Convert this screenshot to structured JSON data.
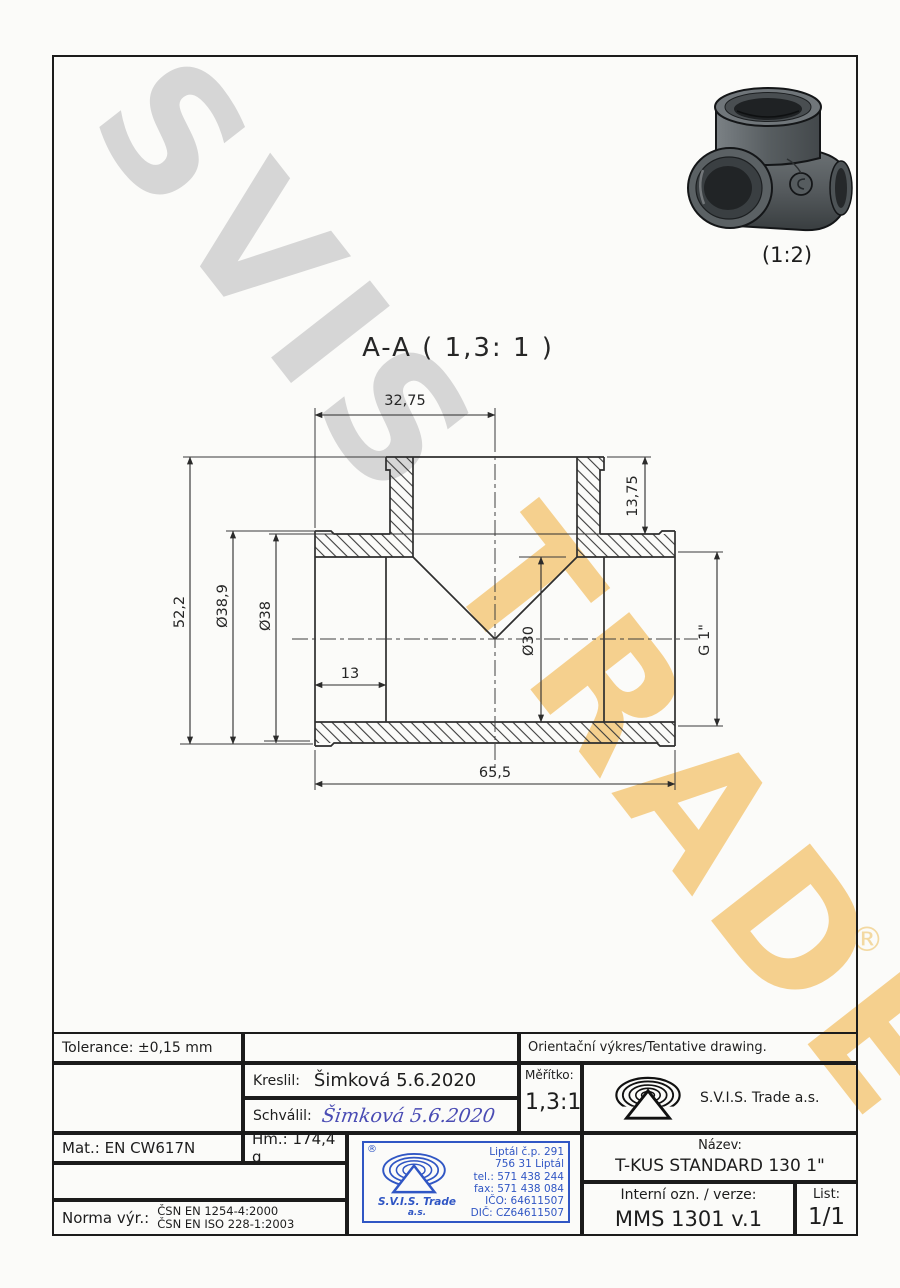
{
  "watermark": {
    "part1": "SVIS",
    "part2": "TRADE",
    "registered": "®",
    "color_gray": "#d6d6d6",
    "color_yellow": "#f5c97c"
  },
  "pictorial": {
    "scale_label": "(1:2)"
  },
  "section": {
    "title": "A-A ( 1,3: 1 )",
    "dims": {
      "top_width": "32,75",
      "height": "52,2",
      "od_bead": "Ø38,9",
      "od_body": "Ø38",
      "port_depth": "13",
      "branch_depth": "13,75",
      "bore": "Ø30",
      "thread": "G 1\"",
      "total_length": "65,5"
    }
  },
  "title_block": {
    "tolerance": "Tolerance: ±0,15 mm",
    "orientation_note": "Orientační výkres/Tentative drawing.",
    "kreslil_label": "Kreslil:",
    "kreslil_value": "Šimková 5.6.2020",
    "schvalil_label": "Schválil:",
    "schvalil_signature": "Šimková 5.6.2020",
    "meritko_label": "Měřítko:",
    "meritko_value": "1,3:1",
    "company": "S.V.I.S. Trade a.s.",
    "mat": "Mat.: EN CW617N",
    "hm": "Hm.: 174,4 g",
    "nazev_label": "Název:",
    "nazev_value": "T-KUS STANDARD 130 1\"",
    "interni_label": "Interní ozn. / verze:",
    "interni_value": "MMS 1301 v.1",
    "list_label": "List:",
    "list_value": "1/1",
    "norma_label": "Norma výr.:",
    "norma_line1": "ČSN EN 1254-4:2000",
    "norma_line2": "ČSN EN ISO 228-1:2003"
  },
  "stamp": {
    "registered": "®",
    "company_line1": "S.V.I.S. Trade",
    "company_line2": "a.s.",
    "lines": [
      "Liptál č.p. 291",
      "756 31 Liptál",
      "tel.: 571 438 244",
      "fax: 571 438 084",
      "IČO: 64611507",
      "DIČ: CZ64611507"
    ],
    "color": "#3056c4"
  }
}
